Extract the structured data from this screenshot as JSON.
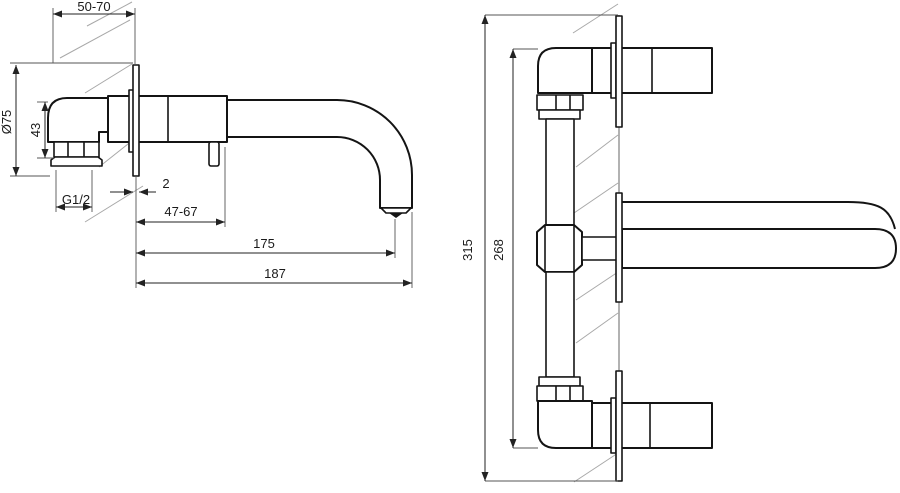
{
  "drawing": {
    "colors": {
      "background": "#ffffff",
      "outline": "#141414",
      "dimension": "#222222",
      "extension": "#555555",
      "hatch": "#a8a8a8"
    },
    "side_view": {
      "dim_wall_depth": "50-70",
      "dim_escutcheon_diameter": "Ø75",
      "dim_body_height": "43",
      "dim_thread": "G1/2",
      "dim_plate_thickness": "2",
      "dim_rough_in": "47-67",
      "dim_spout_reach": "175",
      "dim_total_reach": "187"
    },
    "front_view": {
      "dim_overall_height": "315",
      "dim_pipe_length": "268"
    }
  }
}
